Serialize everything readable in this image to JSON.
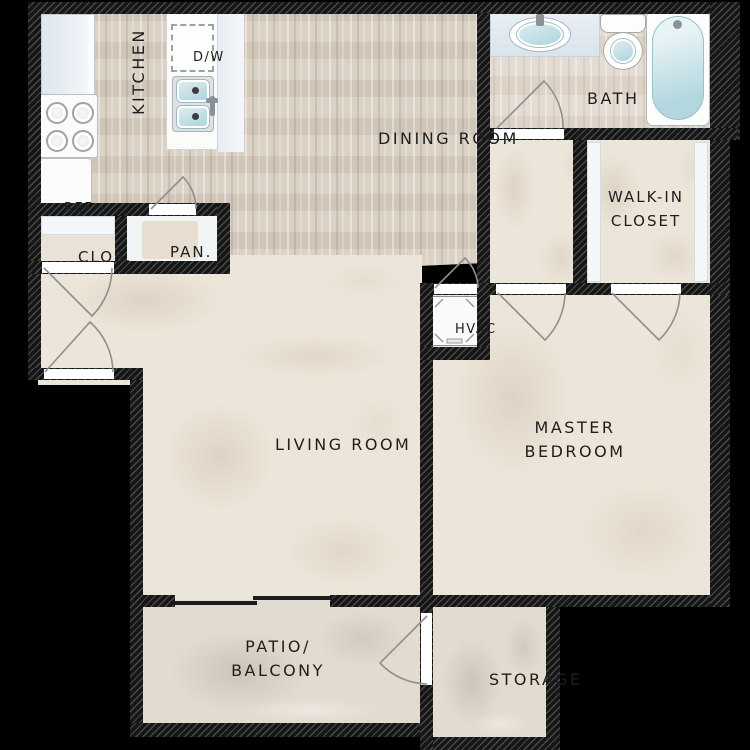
{
  "plan_labels": {
    "kitchen": "KITCHEN",
    "dining_room": "DINING ROOM",
    "bath": "BATH",
    "walk_in_closet_line1": "WALK-IN",
    "walk_in_closet_line2": "CLOSET",
    "living_room": "LIVING ROOM",
    "master_bedroom_line1": "MASTER",
    "master_bedroom_line2": "BEDROOM",
    "patio_line1": "PATIO/",
    "patio_line2": "BALCONY",
    "storage": "STORAGE",
    "hvac": "HVAC",
    "closet": "CLOS.",
    "pantry": "PAN.",
    "refrigerator": "REF.",
    "dishwasher": "D/W"
  },
  "colors": {
    "background": "#000000",
    "wall_fill": "#161616",
    "wall_hatch": "#4a4a4a",
    "carpet": "#ece5d9",
    "wood_floor": "#d7cdc0",
    "patio_floor": "#e2dbd0",
    "fixture_white": "#fbfbfa",
    "counter_blue": "#dfe8ee",
    "water_teal": "#b9dbe2",
    "door_arc": "#8f8f8f",
    "label_ink": "#1e1e1e"
  }
}
